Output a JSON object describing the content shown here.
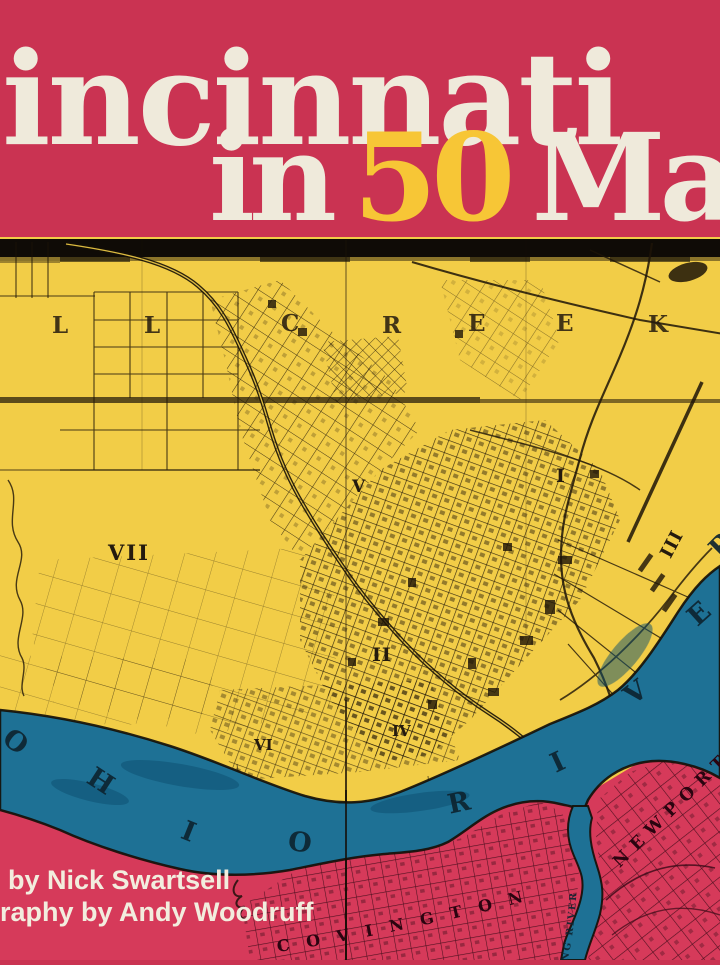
{
  "banner": {
    "title_line1": "incinnati",
    "title_word_in": "in",
    "title_word_number": "50",
    "title_word_maps": "Maps",
    "background_color": "#CA3352",
    "title_color": "#EFEADB",
    "number_color": "#F7C636"
  },
  "credits": {
    "line1": "by Nick Swartsell",
    "line2": "raphy by Andy Woodruff",
    "color": "#F2EDDE"
  },
  "map": {
    "land_color": "#F2CD47",
    "river_color": "#1E7195",
    "kentucky_color": "#D63A5A",
    "ink_color": "#1d1408",
    "kentucky_ink_color": "#380a16",
    "creek_letters": [
      "L",
      "L",
      "C",
      "R",
      "E",
      "E",
      "K"
    ],
    "ward_labels": {
      "vii": "VII",
      "v": "V",
      "i": "I",
      "ii": "II",
      "iii": "III",
      "iv": "IV",
      "vi": "VI"
    },
    "river_letters": [
      "O",
      "H",
      "I",
      "O",
      "R",
      "I",
      "V",
      "E",
      "R"
    ],
    "covington": "COVINGTON",
    "newport": "NEWPORT",
    "licking": "LICKING RIVER"
  }
}
